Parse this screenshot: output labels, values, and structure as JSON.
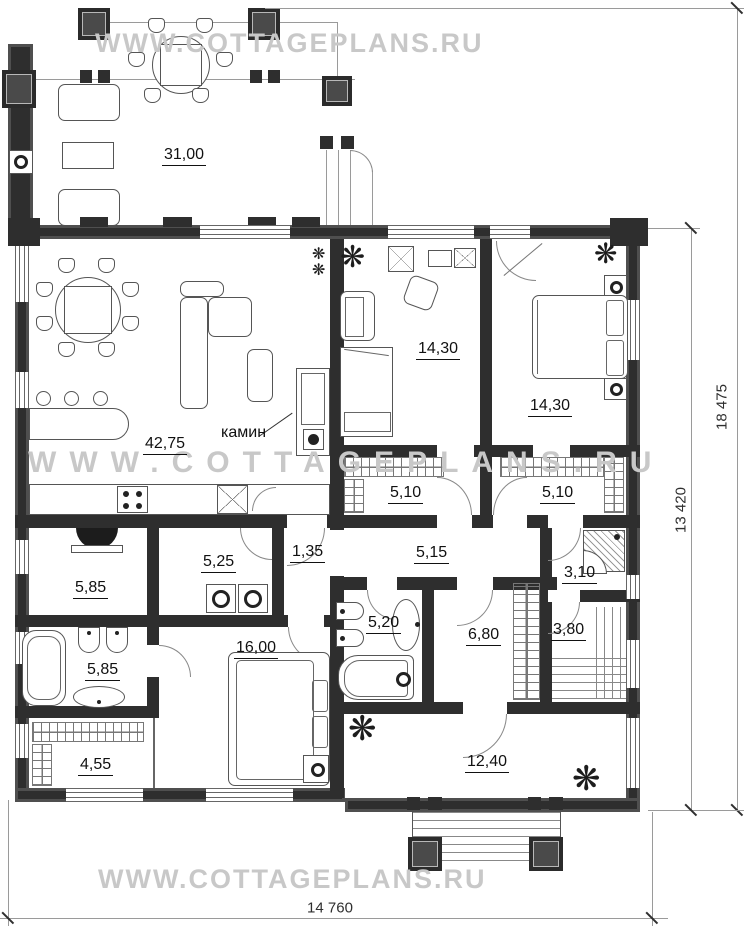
{
  "watermark": {
    "text": "WWW.COTTAGEPLANS.RU"
  },
  "icons": {
    "plant_glyph": "❋"
  },
  "annotations": {
    "fireplace_label": "камин"
  },
  "rooms": {
    "veranda": {
      "area": "31,00"
    },
    "living_kitchen": {
      "area": "42,75"
    },
    "bedroom_left": {
      "area": "14,30"
    },
    "bedroom_right": {
      "area": "14,30"
    },
    "wardrobe_left": {
      "area": "5,10"
    },
    "wardrobe_right": {
      "area": "5,10"
    },
    "utility": {
      "area": "5,85"
    },
    "laundry": {
      "area": "5,25"
    },
    "vestibule": {
      "area": "1,35"
    },
    "hallway": {
      "area": "5,15"
    },
    "shower_room": {
      "area": "3,10"
    },
    "bathroom_master": {
      "area": "5,85"
    },
    "wc": {
      "area": "5,20"
    },
    "dressing": {
      "area": "6,80"
    },
    "sauna": {
      "area": "3,80"
    },
    "bedroom_master": {
      "area": "16,00"
    },
    "closet": {
      "area": "4,55"
    },
    "terrace": {
      "area": "12,40"
    }
  },
  "dimensions": {
    "overall_width": "14 760",
    "inner_depth": "13 420",
    "overall_depth": "18 475"
  },
  "colors": {
    "wall": "#2e2e2e",
    "watermark": "#c8c8c8",
    "line": "#9a9a9a",
    "furniture": "#555555"
  }
}
